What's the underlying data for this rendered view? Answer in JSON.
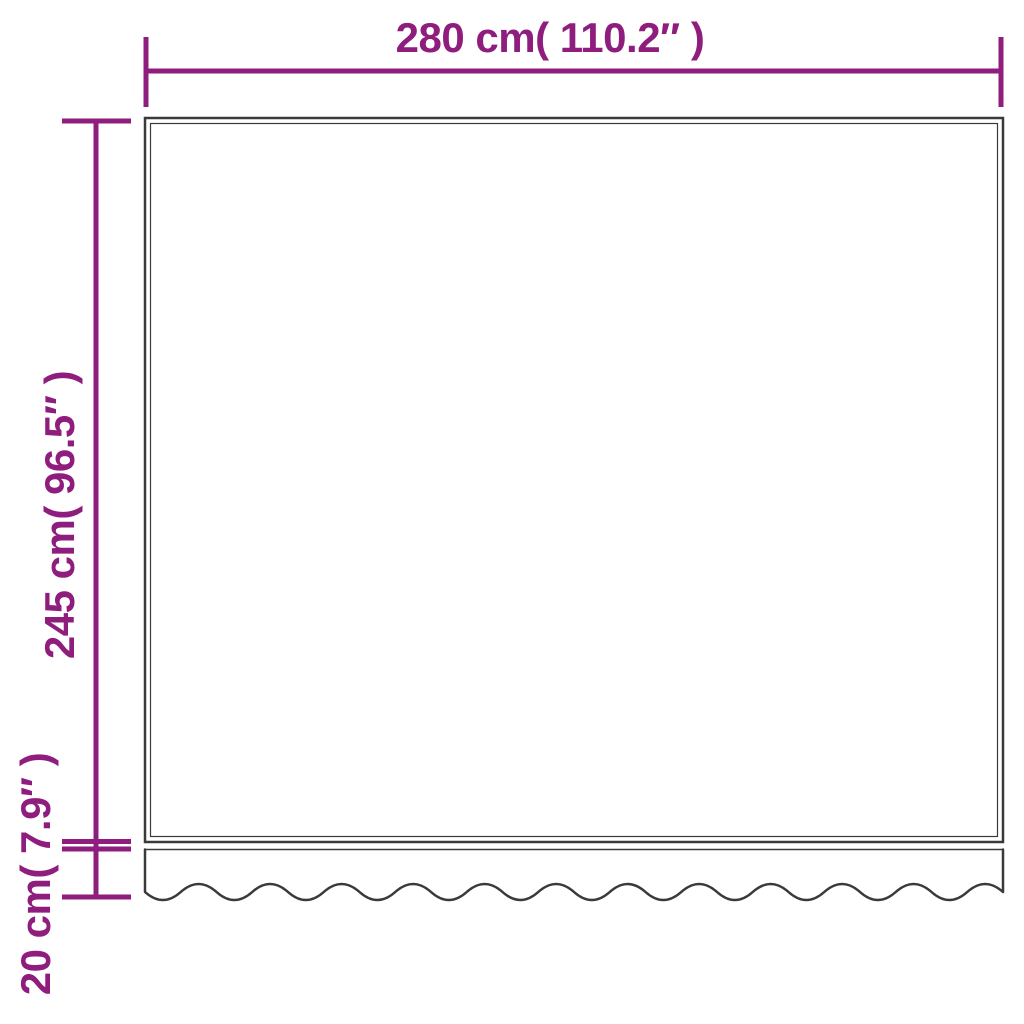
{
  "colors": {
    "accent": "#8e1d7d",
    "outline": "#3a3a3a",
    "background": "#ffffff"
  },
  "diagram": {
    "width_dimension": {
      "label": "280 cm( 110.2″ )"
    },
    "height_dimension": {
      "label": "245 cm( 96.5″ )"
    },
    "valance_dimension": {
      "label": "20 cm( 7.9″ )"
    }
  }
}
